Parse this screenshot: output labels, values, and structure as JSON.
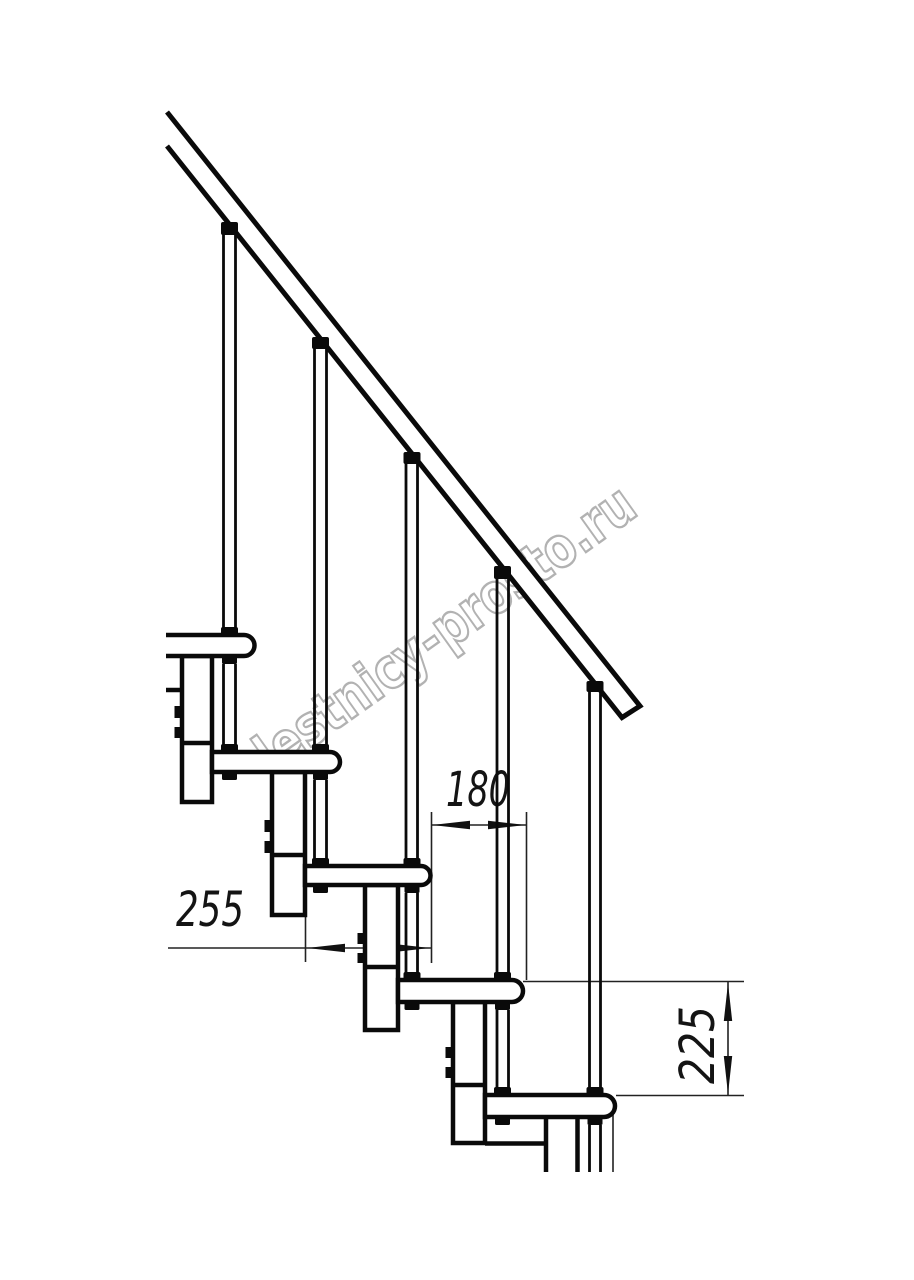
{
  "drawing": {
    "description": "Side-view technical drawing of a modular staircase with handrail, balusters, treads and spine modules",
    "background": "#ffffff",
    "line_color": "#0a0a0a",
    "thin_line_color": "#222222",
    "watermark": {
      "text": "lestnicy-prosto.ru",
      "outline_color": "#b2b2b2"
    },
    "dimensions": {
      "tread_depth": {
        "value": "255",
        "orientation": "horizontal"
      },
      "step_run": {
        "value": "180",
        "orientation": "horizontal"
      },
      "step_rise": {
        "value": "225",
        "orientation": "vertical"
      }
    }
  }
}
